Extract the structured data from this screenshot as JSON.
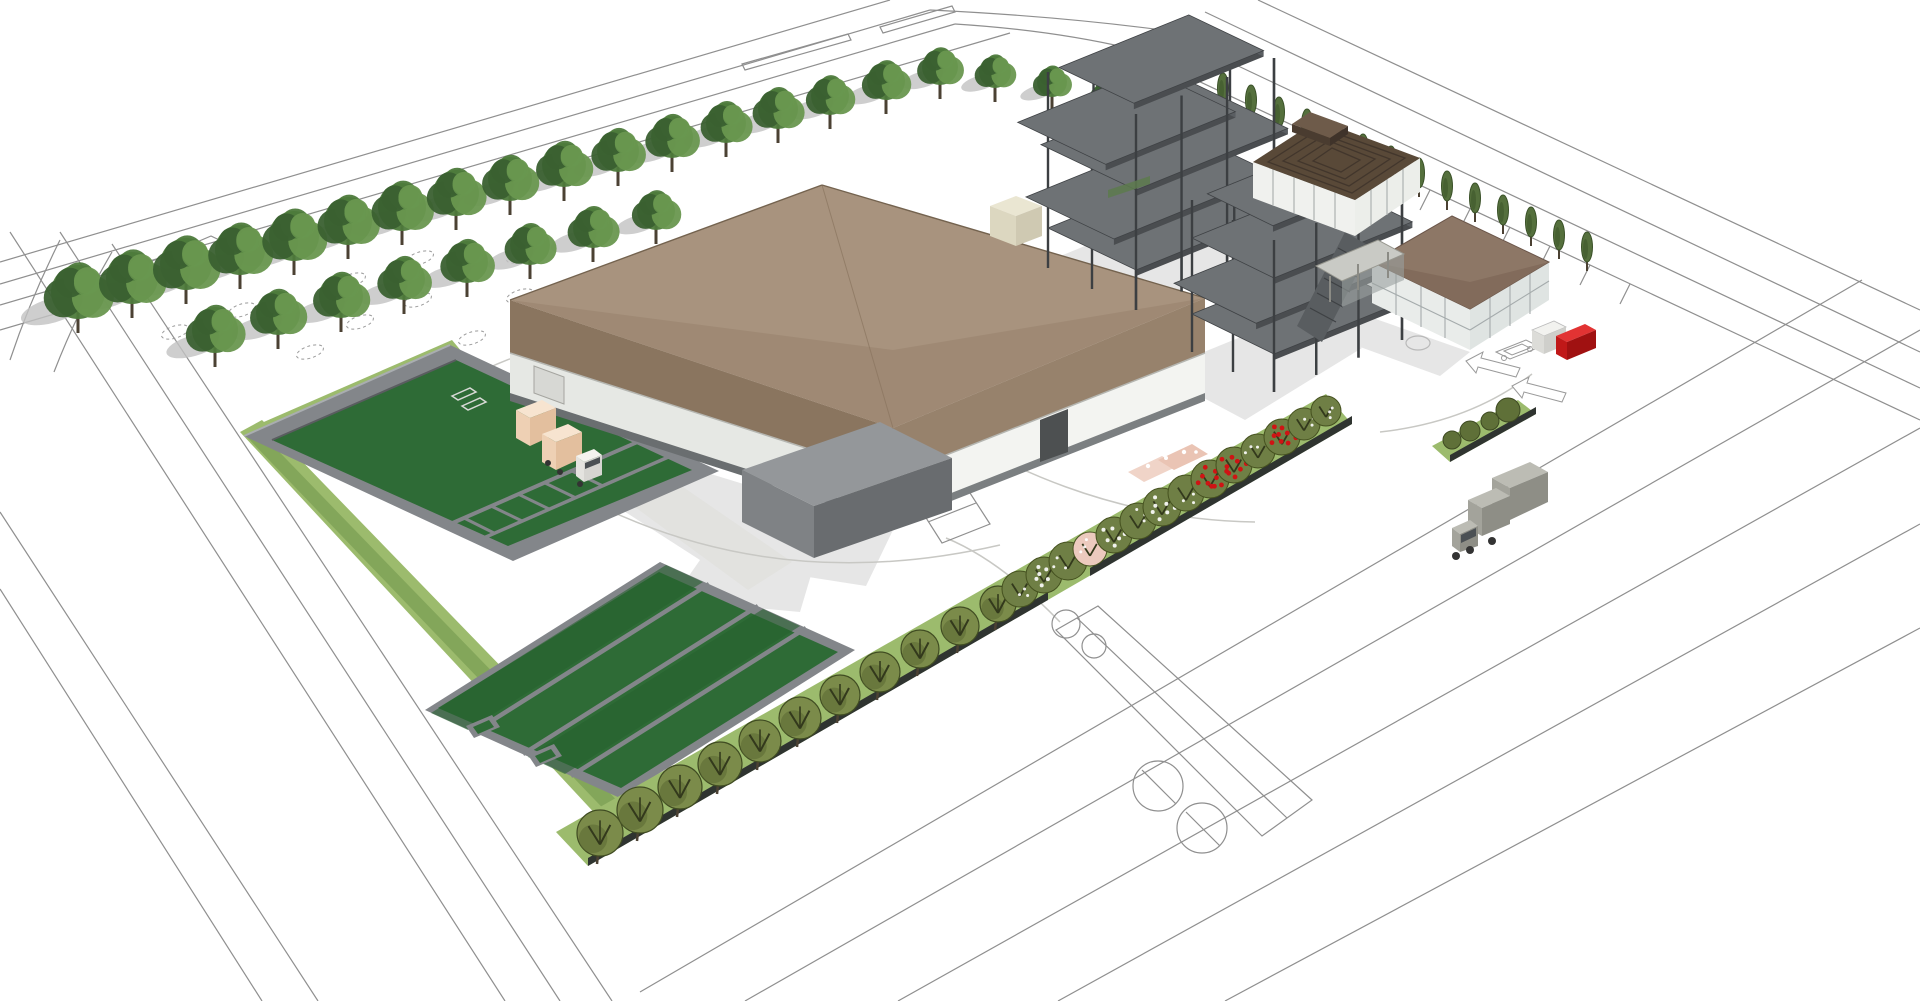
{
  "meta": {
    "description": "Aerial 3D architectural rendering of an industrial wastewater-treatment plant site with production hall, steel frames under construction, green treatment basins, tree rows, outline roads, trucks and gated entrance",
    "render_style": "sketchup-white-background"
  },
  "palette": {
    "bg": "#ffffff",
    "line": "#8f8f8f",
    "shadow": "#d6d6d6",
    "treeShadow": "#c2c2c2",
    "paveGray": "#e2e2df",
    "paveArc": "#c8c8c4",
    "roofTop": "#a5907b",
    "roofTopLight": "#a8937e",
    "roofTopDark": "#9c8772",
    "fasciaSW": "#8a755f",
    "fasciaSE": "#97826c",
    "eaveEdge": "#74634f",
    "wallSW": "#e6e8e4",
    "wallSE": "#f3f4f1",
    "plinth": "#6a6e70",
    "plinthSE": "#7b7f81",
    "doorDark": "#4d5051",
    "doorLight": "#d7d8d4",
    "annexTop": "#94979a",
    "annexSW": "#7f8285",
    "annexSE": "#696c6f",
    "steelCol": "#3c3f42",
    "slabTop": "#6e7275",
    "slabEdge": "#4a4d50",
    "slabEdge2": "#5a5e62",
    "stair": "#595d60",
    "stairLine": "#3e4144",
    "greenPanel": "#5d7a4e",
    "slatRoof": "#594938",
    "slatLine": "#42362c",
    "ridgeTop": "#6e5b4a",
    "ridgeFront": "#4a3c30",
    "ridgeSide": "#3f332a",
    "officeRoof": "#8d7766",
    "officeRoofShade": "#826b5b",
    "officeEave": "#6b564a",
    "glassSW": "#e9ecea",
    "glassSE": "#dfe4e2",
    "mullion": "#a5abac",
    "wallWhite": "#f0f1ee",
    "wallWhite2": "#eceeea",
    "canopySlab": "#c9cac5",
    "canopyPost": "#8b8b85",
    "porchShade": "#9aa09e",
    "basinWall": "#83868a",
    "basinWallLight": "#a9adb0",
    "basinWallDark": "#5a5d60",
    "basinGreen": "#2e6b36",
    "basinGreenDark": "#27602f",
    "grass": "#9cbb6d",
    "hedgeGreen": "#7fa257",
    "hedgeWall": "#2f3430",
    "canopyBase": "#4d7a3b",
    "canopyLight": "#69974f",
    "canopyDark": "#3a6030",
    "trunk": "#4b4133",
    "olive": "#7b8b4a",
    "oliveDark": "#5b6a33",
    "oliveOutline": "#404c22",
    "branchDark": "#33391c",
    "flowGreen": "#6f7f45",
    "flowGreenOutline": "#45511f",
    "flowerRed": "#cf1414",
    "blossomPink": "#eccabe",
    "pinkStruct": "#f0d4c8",
    "pinkStruct2": "#eac4b4",
    "shrub": "#5f7038",
    "shrubOutline": "#3e4a22",
    "poplar": "#55703d",
    "poplarDark": "#3a5128",
    "truckTan": "#f7e4d0",
    "truckTanMid": "#eed0b4",
    "truckTanDark": "#e3bf9e",
    "cabWhite": "#f4f3ef",
    "cabWhite2": "#e4e3df",
    "cabWhite3": "#d6d5d1",
    "windshield": "#4b5054",
    "wheel": "#333333",
    "truckGrayTop": "#bcbcb4",
    "truckGrayMid": "#a3a39b",
    "truckGrayDark": "#8e8e86",
    "gateRedTop": "#e23333",
    "gateRedFront": "#c01818",
    "gateRedSide": "#a01111",
    "boothTop": "#f2f2ef",
    "boothFront": "#dcdcd8",
    "boothSide": "#cfcfcb",
    "creamTop": "#eae6d2",
    "creamFront": "#dcd7c0",
    "creamSide": "#cfc9b2",
    "arrowFill": "#ffffff",
    "arrowStroke": "#9a9a9a"
  },
  "scene": {
    "labels": {
      "site": "industrial-plant-site-plan",
      "mainHall": "main-production-hall",
      "annex": "service-annex",
      "steelA": "steel-frame-structure-a",
      "steelB": "steel-frame-structure-b",
      "slatBuilding": "louvered-roof-building",
      "office": "office-building-with-canopy",
      "basins": "water-treatment-basins",
      "gate": "entrance-gate-red-barrier",
      "truckTan": "delivery-truck-loading",
      "truckGray": "truck-on-road"
    },
    "nwTrees": [
      [
        78,
        292,
        27
      ],
      [
        132,
        278,
        26
      ],
      [
        186,
        264,
        26
      ],
      [
        240,
        250,
        25
      ],
      [
        294,
        236,
        25
      ],
      [
        348,
        221,
        24
      ],
      [
        402,
        207,
        24
      ],
      [
        456,
        193,
        23
      ],
      [
        510,
        179,
        22
      ],
      [
        564,
        165,
        22
      ],
      [
        618,
        151,
        21
      ],
      [
        672,
        137,
        21
      ],
      [
        726,
        123,
        20
      ],
      [
        778,
        109,
        20
      ],
      [
        830,
        96,
        19
      ],
      [
        886,
        81,
        19
      ],
      [
        940,
        67,
        18
      ],
      [
        215,
        330,
        23
      ],
      [
        278,
        313,
        22
      ],
      [
        341,
        296,
        22
      ],
      [
        404,
        279,
        21
      ],
      [
        467,
        262,
        21
      ],
      [
        530,
        245,
        20
      ],
      [
        593,
        228,
        20
      ],
      [
        656,
        211,
        19
      ],
      [
        995,
        72,
        16
      ],
      [
        1052,
        82,
        15
      ],
      [
        1108,
        93,
        14
      ],
      [
        1165,
        103,
        13
      ],
      [
        1222,
        112,
        13
      ]
    ],
    "treePits": [
      [
        175,
        332
      ],
      [
        242,
        310
      ],
      [
        310,
        352
      ],
      [
        360,
        322
      ],
      [
        418,
        300
      ],
      [
        472,
        338
      ],
      [
        520,
        296
      ],
      [
        575,
        312
      ],
      [
        520,
        256
      ],
      [
        612,
        276
      ],
      [
        658,
        300
      ],
      [
        705,
        262
      ],
      [
        420,
        258
      ],
      [
        352,
        280
      ],
      [
        950,
        315
      ],
      [
        1002,
        330
      ],
      [
        1152,
        372
      ],
      [
        1188,
        394
      ]
    ],
    "poplars": [
      [
        1223,
        88
      ],
      [
        1251,
        100
      ],
      [
        1279,
        112
      ],
      [
        1307,
        124
      ],
      [
        1335,
        137
      ],
      [
        1363,
        149
      ],
      [
        1391,
        161
      ],
      [
        1419,
        173
      ],
      [
        1447,
        186
      ],
      [
        1475,
        198
      ],
      [
        1503,
        210
      ],
      [
        1531,
        222
      ],
      [
        1559,
        235
      ],
      [
        1587,
        247
      ]
    ],
    "roundTrees": [
      [
        600,
        833,
        23
      ],
      [
        640,
        810,
        23
      ],
      [
        680,
        787,
        22
      ],
      [
        720,
        764,
        22
      ],
      [
        760,
        741,
        21
      ],
      [
        800,
        718,
        21
      ],
      [
        840,
        695,
        20
      ],
      [
        880,
        672,
        20
      ],
      [
        920,
        649,
        19
      ],
      [
        960,
        626,
        19
      ],
      [
        998,
        604,
        18
      ]
    ],
    "flowering": [
      [
        1020,
        589,
        18,
        "g"
      ],
      [
        1044,
        575,
        18,
        "w"
      ],
      [
        1068,
        561,
        19,
        "g"
      ],
      [
        1090,
        549,
        17,
        "p"
      ],
      [
        1114,
        535,
        18,
        "w"
      ],
      [
        1138,
        521,
        18,
        "g"
      ],
      [
        1162,
        507,
        19,
        "w"
      ],
      [
        1186,
        493,
        18,
        "g"
      ],
      [
        1210,
        479,
        19,
        "r"
      ],
      [
        1234,
        465,
        18,
        "r"
      ],
      [
        1258,
        451,
        17,
        "g"
      ],
      [
        1282,
        437,
        18,
        "r"
      ],
      [
        1304,
        424,
        16,
        "g"
      ],
      [
        1326,
        411,
        15,
        "g"
      ]
    ],
    "gateShrubs": [
      [
        1452,
        440,
        9
      ],
      [
        1470,
        431,
        10
      ],
      [
        1490,
        421,
        9
      ],
      [
        1508,
        410,
        12
      ]
    ],
    "steel": {
      "blockA": {
        "o": [
          1048,
          268
        ],
        "a": [
          138,
          -56
        ],
        "b": [
          88,
          42
        ],
        "h": 196,
        "levels": [
          {
            "z": 40
          },
          {
            "z": 80,
            "u": [
              -0.16,
              1
            ]
          },
          {
            "z": 120,
            "u": [
              0,
              1.1
            ],
            "v": [
              -0.08,
              1
            ]
          },
          {
            "z": 158,
            "u": [
              -0.22,
              0.72
            ]
          },
          {
            "z": 196,
            "u": [
              0.08,
              1.02
            ],
            "v": [
              0,
              0.85
            ]
          }
        ]
      },
      "blockB": {
        "o": [
          1192,
          352
        ],
        "a": [
          128,
          -52
        ],
        "b": [
          82,
          40
        ],
        "h": 152,
        "levels": [
          {
            "z": 38
          },
          {
            "z": 76,
            "u": [
              -0.14,
              1
            ]
          },
          {
            "z": 114,
            "u": [
              0,
              1.08
            ]
          },
          {
            "z": 152,
            "u": [
              0.12,
              1
            ],
            "v": [
              0,
              0.8
            ]
          }
        ]
      }
    }
  }
}
